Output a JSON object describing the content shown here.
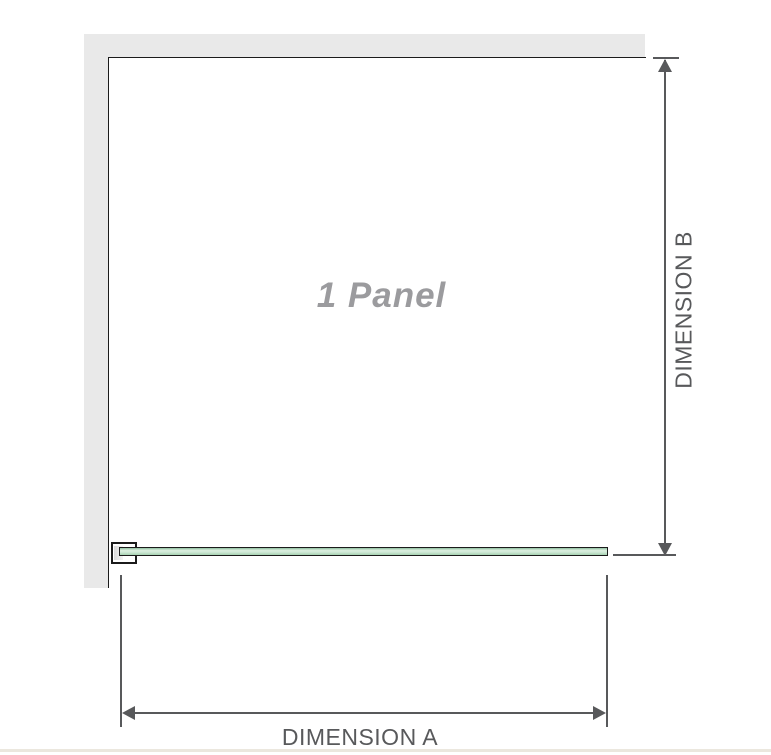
{
  "diagram": {
    "panel_label": "1 Panel",
    "dimension_a_label": "DIMENSION A",
    "dimension_b_label": "DIMENSION B"
  },
  "colors": {
    "wall": "#e9e9e9",
    "outline": "#1b1b1b",
    "dimension": "#58595b",
    "panel_text": "#9b9b9e",
    "glass_light": "#dcefe0",
    "glass_dark": "#8fbf9f",
    "baseline_strip": "#ebe7de"
  }
}
